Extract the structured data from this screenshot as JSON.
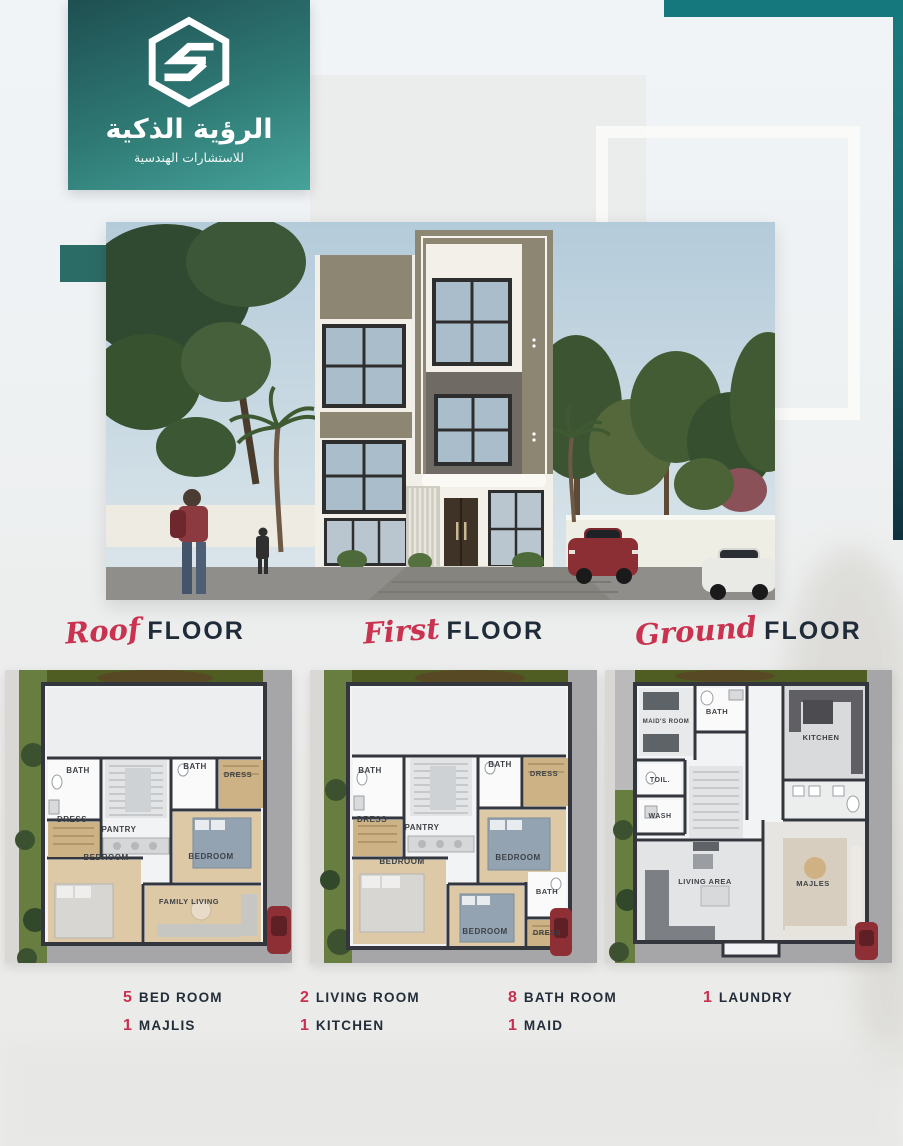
{
  "brand": {
    "title_ar": "الرؤية الذكية",
    "subtitle_ar": "للاستشارات الهندسية",
    "logo_icon": "hexagon-s-logo"
  },
  "colors": {
    "teal": "#15787c",
    "teal_dark": "#1e4f51",
    "teal_light": "#46a39a",
    "accent_red": "#c9304e",
    "navy": "#1f2b38"
  },
  "floors": [
    {
      "script": "Roof",
      "label": "FLOOR"
    },
    {
      "script": "First",
      "label": "FLOOR"
    },
    {
      "script": "Ground",
      "label": "FLOOR"
    }
  ],
  "plans": {
    "roof": {
      "labels": [
        "BATH",
        "DRESS",
        "BATH",
        "DRESS",
        "PANTRY",
        "BEDROOM",
        "BEDROOM",
        "FAMILY LIVING"
      ]
    },
    "first": {
      "labels": [
        "BATH",
        "DRESS",
        "BATH",
        "DRESS",
        "PANTRY",
        "BEDROOM",
        "BEDROOM",
        "BEDROOM",
        "BATH",
        "DRESS"
      ]
    },
    "ground": {
      "labels": [
        "MAID'S ROOM",
        "BATH",
        "KITCHEN",
        "TOIL.",
        "WASH",
        "LIVING AREA",
        "MAJLES"
      ]
    }
  },
  "stats": {
    "items": [
      {
        "count": "5",
        "label": "BED ROOM"
      },
      {
        "count": "1",
        "label": "MAJLIS"
      },
      {
        "count": "2",
        "label": "LIVING ROOM"
      },
      {
        "count": "1",
        "label": "KITCHEN"
      },
      {
        "count": "8",
        "label": "BATH ROOM"
      },
      {
        "count": "1",
        "label": "MAID"
      },
      {
        "count": "1",
        "label": "LAUNDRY"
      }
    ]
  }
}
